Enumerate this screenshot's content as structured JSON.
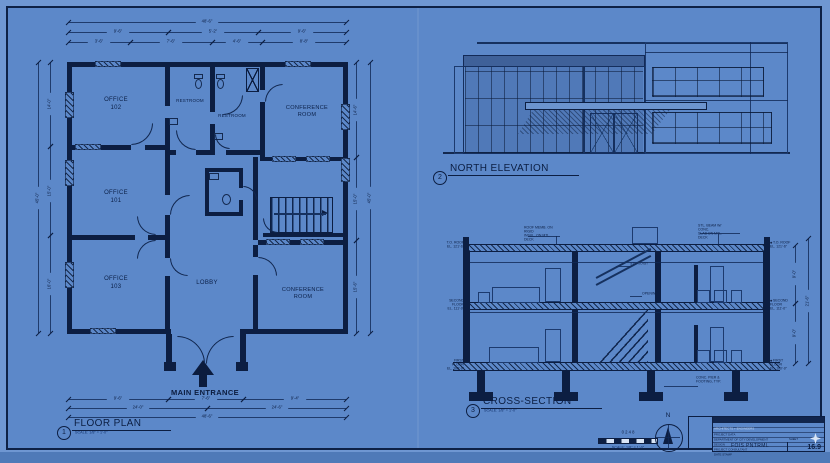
{
  "palette": {
    "sheet": "#5c88c9",
    "margin": "#6f97d2",
    "ink": "#0c1e42",
    "line": "#1c3a70",
    "light_text": "#c9daf2"
  },
  "icons": {
    "north-arrow-icon": "triangle-needle",
    "star-icon": "four-point-star",
    "entrance-arrow-icon": "up-arrow",
    "elevation-marker-icon": "diamond"
  },
  "floor_plan": {
    "number": "1",
    "title": "FLOOR PLAN",
    "scale": "SCALE: 1/8\" = 1'-0\"",
    "entrance_label": "MAIN ENTRANCE",
    "rooms": {
      "office102": "OFFICE\n102",
      "restroom1": "RESTROOM",
      "restroom2": "RESTROOM",
      "conference_top": "CONFERENCE\nROOM",
      "office101": "OFFICE\n101",
      "office103": "OFFICE\n103",
      "lobby": "LOBBY",
      "conference_bottom": "CONFERENCE\nROOM"
    },
    "dims": {
      "t1": "48'-6\"",
      "t2": [
        "9'-6\"",
        "5'-2\"",
        "9'-6\""
      ],
      "t3": [
        "3'-6\"",
        "7'-6\"",
        "4'-6\"",
        "8'-8\""
      ],
      "b1": [
        "9'-6\"",
        "7'-6\"",
        "9'-4\""
      ],
      "b2": [
        "24'-0\"",
        "24'-6\""
      ],
      "b3": "48'-6\"",
      "l1": "45'-0\"",
      "l2": [
        "14'-0\"",
        "15'-0\"",
        "16'-0\""
      ],
      "r1": [
        "14'-6\"",
        "15'-0\"",
        "15'-6\""
      ],
      "r2": "45'-0\""
    }
  },
  "elevation": {
    "number": "2",
    "title": "NORTH ELEVATION"
  },
  "section": {
    "number": "3",
    "title": "CROSS-SECTION",
    "scale": "SCALE: 1/8\" = 1'-0\"",
    "notes": {
      "roof": "ROOF MEMB. ON RIGID\nINSUL. ON MTL. DECK",
      "beam": "STL. BEAM W/ CONC.\nSLAB ON MTL. DECK",
      "joist": "STL. JOIST",
      "opening": "OPENING",
      "footing": "CONC. PIER &\nFOOTING, TYP."
    },
    "markers": {
      "roof": "T.O. ROOF\nEL. 121'-6\"",
      "second": "SECOND FLOOR\nEL. 111'-0\"",
      "first": "FIRST FLOOR\nEL. 100'-0\""
    },
    "dims": {
      "s1": [
        "9'-0\"",
        "9'-0\""
      ],
      "s2": "21'-6\""
    }
  },
  "scale_bar": {
    "ticks": "0      2      4      8",
    "label": "SCALE: 1/8\" = 1'-0\""
  },
  "north_arrow": {
    "label": "N"
  },
  "title_block": {
    "header": "ARCHITECTS + ENGINEERS",
    "rows": [
      "PROJECT DATA",
      "DEPARTMENT OF CITY DEVELOPMENT",
      "DESIGN",
      "PROJECT CONSULTANT",
      "DATE STAMP"
    ],
    "name": "FOIS PNTRML",
    "sheet_label": "SHEET",
    "sheet_no": "16.9"
  }
}
